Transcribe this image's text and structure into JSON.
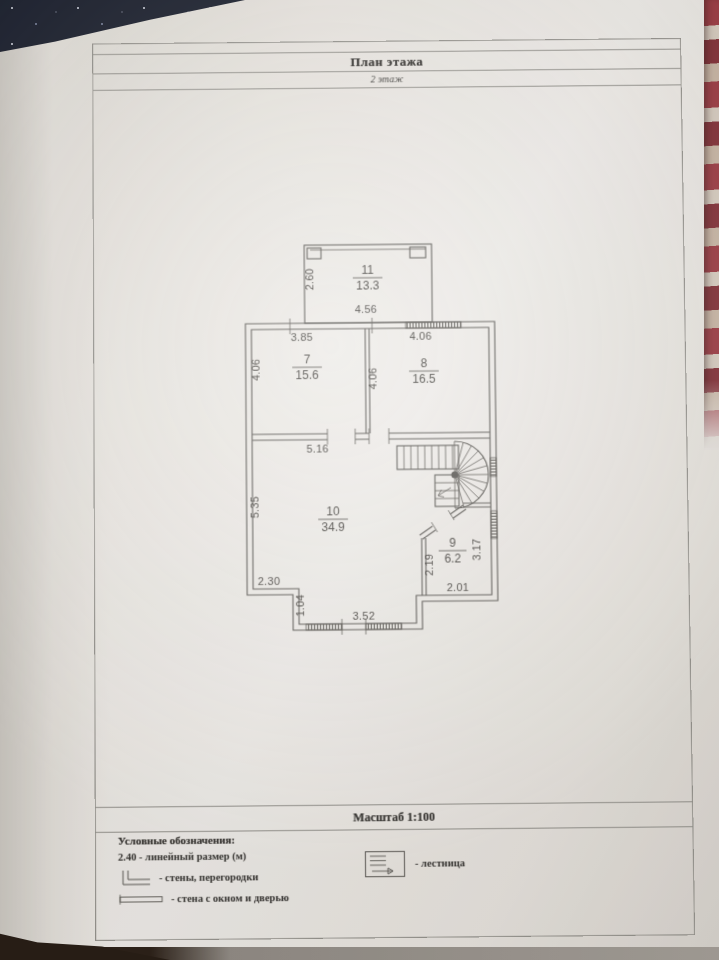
{
  "sheet": {
    "title": "План этажа",
    "floor_label": "2 этаж",
    "scale_label": "Масштаб 1:100"
  },
  "plan": {
    "rooms": [
      {
        "number": "11",
        "area": "13.3"
      },
      {
        "number": "7",
        "area": "15.6"
      },
      {
        "number": "8",
        "area": "16.5"
      },
      {
        "number": "10",
        "area": "34.9"
      },
      {
        "number": "9",
        "area": "6.2"
      }
    ],
    "dimensions": {
      "r11_left": "2.60",
      "r11_bottom": "4.56",
      "r7_top": "3.85",
      "r7_left": "4.06",
      "r8_top": "4.06",
      "r8_left": "4.06",
      "r10_top": "5.16",
      "r10_left": "5.35",
      "r10_bottom_left": "2.30",
      "r10_step": "1.04",
      "r10_bay_bottom": "3.52",
      "r9_left": "2.19",
      "r9_bottom": "2.01",
      "r9_right": "3.17"
    }
  },
  "legend": {
    "heading": "Условные обозначения:",
    "linear_dim": "2.40 - линейный размер (м)",
    "walls": "- стены, перегородки",
    "wall_window_door": "- стена с окном и дверью",
    "stairs": "- лестница"
  }
}
